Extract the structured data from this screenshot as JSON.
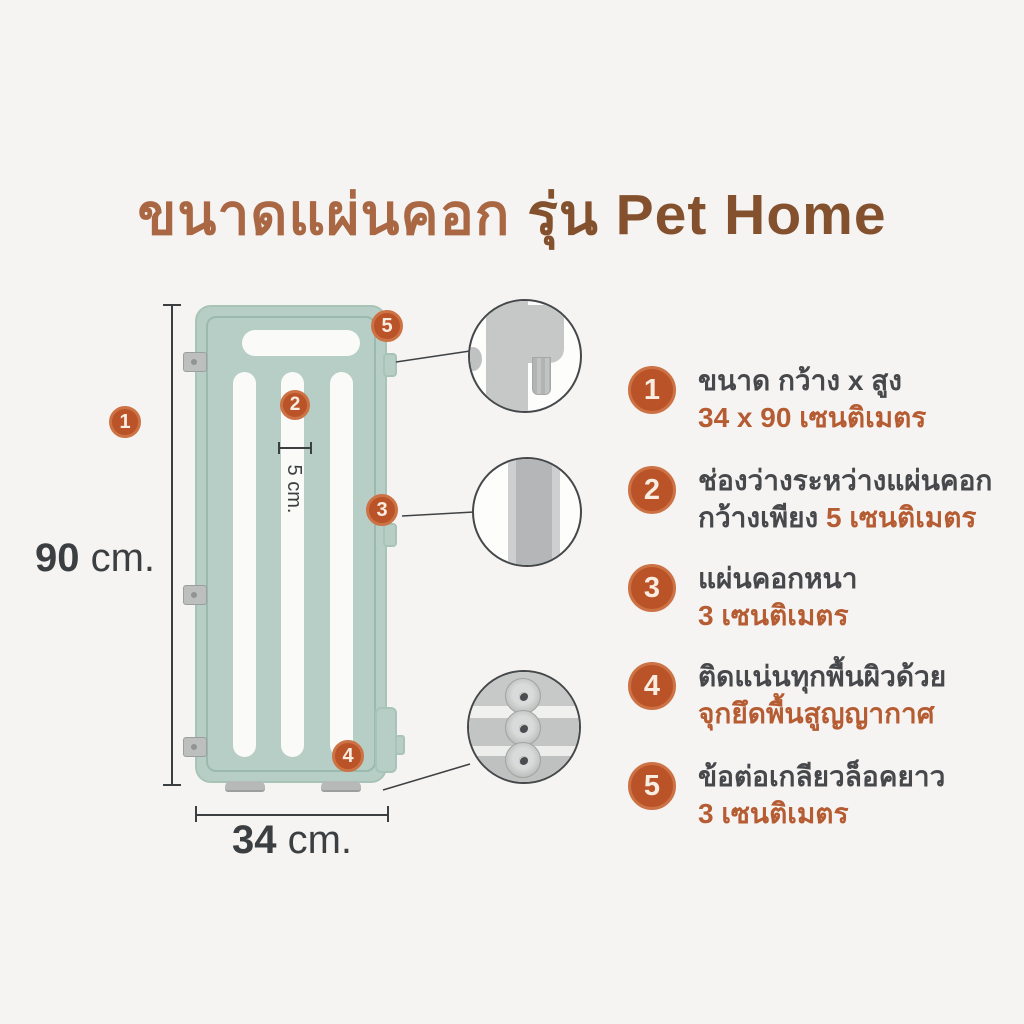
{
  "title": {
    "part1": "ขนาดแผ่นคอก",
    "part2": "รุ่น Pet Home"
  },
  "diagram": {
    "height_value": "90",
    "height_unit": "cm.",
    "width_value": "34",
    "width_unit": "cm.",
    "gap_label": "5 cm."
  },
  "features": [
    {
      "number": "1",
      "line1": "ขนาด กว้าง x สูง",
      "line2_highlight": "34 x 90 เซนติเมตร"
    },
    {
      "number": "2",
      "line1": "ช่องว่างระหว่างแผ่นคอก",
      "line2_prefix": "กว้างเพียง ",
      "line2_highlight": "5 เซนติเมตร"
    },
    {
      "number": "3",
      "line1": "แผ่นคอกหนา",
      "line2_highlight": "3 เซนติเมตร"
    },
    {
      "number": "4",
      "line1": "ติดแน่นทุกพื้นผิวด้วย",
      "line2_highlight": "จุกยึดพื้นสูญญากาศ"
    },
    {
      "number": "5",
      "line1": "ข้อต่อเกลียวล็อคยาว",
      "line2_highlight": "3 เซนติเมตร"
    }
  ],
  "colors": {
    "background": "#f6f4f2",
    "accent_badge": "#ba5428",
    "highlight_text": "#b55c33",
    "title_light": "#a96843",
    "title_dark": "#84512e",
    "fence_green": "#b6cec5",
    "dark_text": "#46484b"
  }
}
